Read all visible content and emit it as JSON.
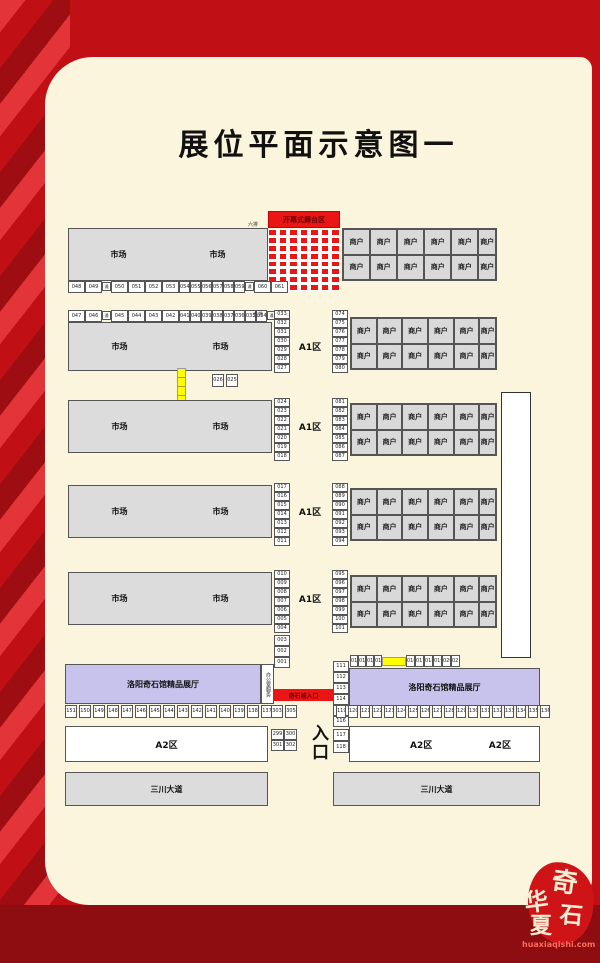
{
  "title": "展位平面示意图一",
  "labels": {
    "market": "市场",
    "merchant": "商户",
    "a1_zone": "A1区",
    "a2_zone": "A2区",
    "stage": "开幕式舞台区",
    "aisle": "通道",
    "row_marker_top": "六排",
    "row_marker_second": "五排",
    "hall": "洛阳奇石馆精品展厅",
    "office": "办公室服务",
    "stone_city_entrance": "奇石城入口",
    "entrance": "入口",
    "avenue": "三川大道"
  },
  "booths": {
    "row1_bottom": [
      "048",
      "049",
      "通道",
      "050",
      "051",
      "052",
      "053",
      "054",
      "055",
      "056",
      "057",
      "058",
      "059",
      "通道",
      "060",
      "061"
    ],
    "row2_top": [
      "047",
      "046",
      "通道",
      "045",
      "044",
      "043",
      "042",
      "041",
      "040",
      "039",
      "038",
      "037",
      "036",
      "035",
      "034",
      "通道"
    ],
    "left_strips": [
      [
        "033",
        "032",
        "031",
        "030",
        "029",
        "028",
        "027"
      ],
      [
        "024",
        "023",
        "022",
        "021",
        "020",
        "019",
        "018"
      ],
      [
        "017",
        "016",
        "015",
        "014",
        "013",
        "012",
        "011"
      ],
      [
        "010",
        "009",
        "008",
        "007",
        "006",
        "005",
        "004"
      ]
    ],
    "right_strips": [
      [
        "074",
        "075",
        "076",
        "077",
        "078",
        "079",
        "080"
      ],
      [
        "081",
        "082",
        "083",
        "084",
        "085",
        "086",
        "087"
      ],
      [
        "088",
        "089",
        "090",
        "091",
        "092",
        "093",
        "094"
      ],
      [
        "095",
        "096",
        "097",
        "098",
        "099",
        "100",
        "101"
      ]
    ],
    "ladder_cells": [
      "026",
      "025"
    ],
    "below_row5": [
      "003",
      "002",
      "001"
    ],
    "hall_left_strip": [
      "111",
      "112",
      "113",
      "114",
      "115",
      "116"
    ],
    "hall_top_left_cells": [
      "012",
      "013",
      "014",
      "015"
    ],
    "hall_top_right_cells": [
      "016",
      "017",
      "018",
      "019",
      "020",
      "021"
    ],
    "strip_117_118": [
      "117",
      "118"
    ],
    "bottom_left_row": [
      "151",
      "150",
      "149",
      "148",
      "147",
      "146",
      "145",
      "144",
      "143",
      "142",
      "141",
      "140",
      "139",
      "138",
      "137"
    ],
    "bottom_left_extra": [
      "303",
      "305"
    ],
    "bottom_right_row": [
      "119",
      "120",
      "121",
      "122",
      "123",
      "124",
      "125",
      "126",
      "127",
      "128",
      "129",
      "130",
      "131",
      "132",
      "133",
      "134",
      "135",
      "136"
    ],
    "mini_grid": [
      "299",
      "300",
      "301",
      "302"
    ]
  },
  "merchant_grid": {
    "cols": 6,
    "rows": 2,
    "count": 5
  },
  "stage_grid": {
    "cols": 7,
    "rows": 8
  },
  "colors": {
    "accent_red": "#ea1515",
    "background_red": "#c01015",
    "dark_red_band": "#8e0d10",
    "card_cream": "#faf5dc",
    "market_gray": "#dcdcdc",
    "hall_lavender": "#c7c3ed",
    "highlight_yellow": "#ffff00"
  },
  "logo": {
    "char1": "华",
    "char2": "夏",
    "char3": "奇",
    "char4": "石",
    "site": "huaxiaqishi.com"
  }
}
